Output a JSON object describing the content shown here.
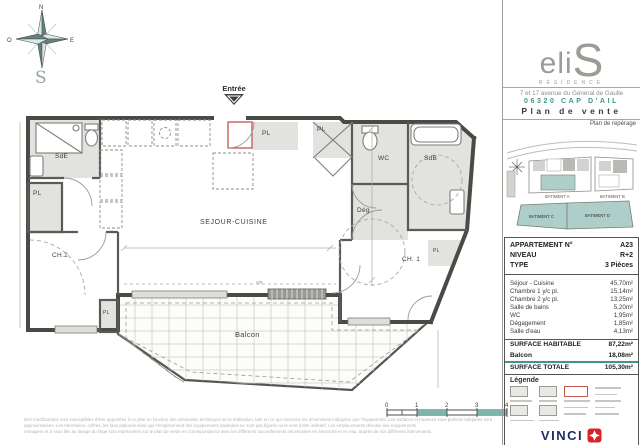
{
  "colors": {
    "teal": "#3f958d",
    "teal_light": "#aecfc9",
    "green": "#8ca64d",
    "navy": "#1d2f66",
    "red": "#d8232a"
  },
  "plan": {
    "compass": {
      "north": "N",
      "east": "E",
      "south": "S",
      "west": "O"
    },
    "entrance_label": "Entrée",
    "labels": {
      "sde": "SdE",
      "pl": "PL",
      "ch2": "CH.2",
      "sejour": "SEJOUR-CUISINE",
      "wc": "WC",
      "deg": "Dég.",
      "sdb": "SdB",
      "ch1": "CH. 1",
      "balcon": "Balcon",
      "vr": "VR"
    },
    "scale_ticks": [
      "0",
      "1",
      "2",
      "3",
      "4"
    ],
    "disclaimer_lines": [
      "Des modifications sont susceptibles d'être apportées à ce plan en fonction des nécessités techniques de la réalisation, tant en ce qui concerne les dimensions indiquées que l'équipement. Les surfaces et hauteurs sous plafond indiquées sont",
      "approximatives. Les retombées, coffres, les faux plafonds ainsi que l'emplacement des équipements sanitaires ne sont pas figurés ou le sont à titre indicatif. Les emplacements dévolus aux équipements",
      "ménagers et à ceux liés au lavage du linge sont représentés sur le plan de vente en correspondance avec les différents raccordements nécessaires en électricité et en eau, auprès de nos différents intervenants."
    ]
  },
  "sidebar": {
    "logo": {
      "word_start": "eli",
      "word_end": "S",
      "subtitle": "RÉSIDENCE"
    },
    "address_line1": "7 et 17 avenue du Général de Gaulle",
    "address_line2": "06320 CAP D'AIL",
    "doc_title": "Plan de vente",
    "reperage_title": "Plan de repérage",
    "buildings": [
      "BATIMENT A",
      "BATIMENT B",
      "BATIMENT C",
      "BATIMENT D"
    ],
    "info_rows": [
      {
        "label": "APPARTEMENT N°",
        "value": "A23"
      },
      {
        "label": "NIVEAU",
        "value": "R+2"
      },
      {
        "label": "TYPE",
        "value": "3 Pièces"
      }
    ],
    "area_rows": [
      {
        "label": "Séjour - Cuisine",
        "value": "45,70m²"
      },
      {
        "label": "Chambre 1 y/c pl.",
        "value": "15,14m²"
      },
      {
        "label": "Chambre 2 y/c pl.",
        "value": "13,25m²"
      },
      {
        "label": "Salle de bains",
        "value": "5,20m²"
      },
      {
        "label": "WC",
        "value": "1,95m²"
      },
      {
        "label": "Dégagement",
        "value": "1,85m²"
      },
      {
        "label": "Salle d'eau",
        "value": "4,13m²"
      }
    ],
    "surface_rows": [
      {
        "label": "SURFACE HABITABLE",
        "value": "87,22m²"
      },
      {
        "label": "Balcon",
        "value": "18,08m²"
      },
      {
        "label": "SURFACE TOTALE",
        "value": "105,30m²"
      }
    ],
    "legend_title": "Légende",
    "vinci_name": "VINCI",
    "vinci_sub": "IMMOBILIER",
    "footer_left": "NOTAIRE",
    "footer_right": "27 juillet 2023"
  }
}
